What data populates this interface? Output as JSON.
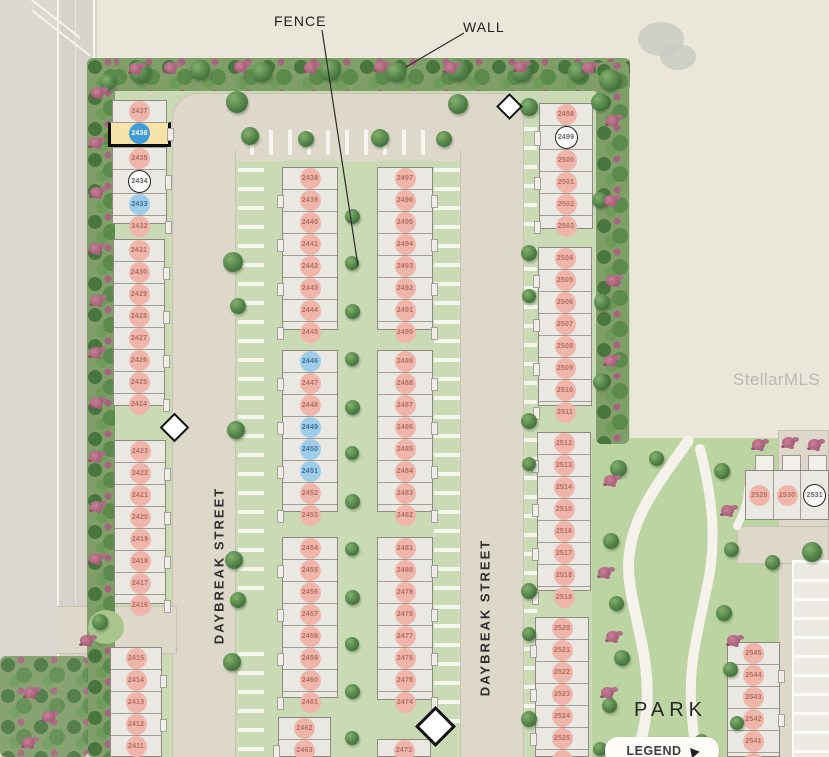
{
  "labels": {
    "fence": "FENCE",
    "wall": "WALL",
    "street": "DAYBREAK STREET",
    "park": "PARK",
    "legend": "LEGEND",
    "watermark": "StellarMLS"
  },
  "colors": {
    "lot_pink": "#efb5ab",
    "lot_blue": "#9fcde9",
    "highlight_unit_yellow": "#f6e3a8",
    "highlight_circle_blue": "#3f9bd8",
    "road_tan": "#ddd8ca",
    "green": "#c9dab4",
    "hedge_green": "#7f9e68"
  },
  "buildings": [
    {
      "name": "bldg-2432-2437",
      "x": 112,
      "y": 100,
      "w": 55,
      "h": 124,
      "dir": "v",
      "porch": "e",
      "lots": [
        {
          "n": "2437",
          "s": "pink"
        },
        {
          "n": "2436",
          "s": "highlight"
        },
        {
          "n": "2435",
          "s": "pink"
        },
        {
          "n": "2434",
          "s": "circled"
        },
        {
          "n": "2433",
          "s": "blue"
        },
        {
          "n": "2432",
          "s": "pink"
        }
      ]
    },
    {
      "name": "bldg-2424-2431",
      "x": 113,
      "y": 239,
      "w": 52,
      "h": 167,
      "dir": "v",
      "porch": "e",
      "lots": [
        {
          "n": "2431",
          "s": "pink"
        },
        {
          "n": "2430",
          "s": "pink"
        },
        {
          "n": "2429",
          "s": "pink"
        },
        {
          "n": "2428",
          "s": "pink"
        },
        {
          "n": "2427",
          "s": "pink"
        },
        {
          "n": "2426",
          "s": "pink"
        },
        {
          "n": "2425",
          "s": "pink"
        },
        {
          "n": "2424",
          "s": "pink"
        }
      ]
    },
    {
      "name": "bldg-2416-2423",
      "x": 114,
      "y": 440,
      "w": 52,
      "h": 164,
      "dir": "v",
      "porch": "e",
      "lots": [
        {
          "n": "2423",
          "s": "pink"
        },
        {
          "n": "2422",
          "s": "pink"
        },
        {
          "n": "2421",
          "s": "pink"
        },
        {
          "n": "2420",
          "s": "pink"
        },
        {
          "n": "2419",
          "s": "pink"
        },
        {
          "n": "2418",
          "s": "pink"
        },
        {
          "n": "2417",
          "s": "pink"
        },
        {
          "n": "2416",
          "s": "pink"
        }
      ]
    },
    {
      "name": "bldg-2410-2415",
      "x": 110,
      "y": 647,
      "w": 52,
      "h": 110,
      "dir": "v",
      "porch": "e",
      "lots": [
        {
          "n": "2415",
          "s": "pink"
        },
        {
          "n": "2414",
          "s": "pink"
        },
        {
          "n": "2413",
          "s": "pink"
        },
        {
          "n": "2412",
          "s": "pink"
        },
        {
          "n": "2411",
          "s": "pink"
        },
        {
          "n": "2410",
          "s": "pink"
        }
      ]
    },
    {
      "name": "bldg-2438-2445",
      "x": 282,
      "y": 167,
      "w": 56,
      "h": 163,
      "dir": "v",
      "porch": "w",
      "lots": [
        {
          "n": "2438",
          "s": "pink"
        },
        {
          "n": "2439",
          "s": "pink"
        },
        {
          "n": "2440",
          "s": "pink"
        },
        {
          "n": "2441",
          "s": "pink"
        },
        {
          "n": "2442",
          "s": "pink"
        },
        {
          "n": "2443",
          "s": "pink"
        },
        {
          "n": "2444",
          "s": "pink"
        },
        {
          "n": "2445",
          "s": "pink"
        }
      ]
    },
    {
      "name": "bldg-2446-2453",
      "x": 282,
      "y": 350,
      "w": 56,
      "h": 162,
      "dir": "v",
      "porch": "w",
      "lots": [
        {
          "n": "2446",
          "s": "blue"
        },
        {
          "n": "2447",
          "s": "pink"
        },
        {
          "n": "2448",
          "s": "pink"
        },
        {
          "n": "2449",
          "s": "blue"
        },
        {
          "n": "2450",
          "s": "blue"
        },
        {
          "n": "2451",
          "s": "blue"
        },
        {
          "n": "2452",
          "s": "pink"
        },
        {
          "n": "2453",
          "s": "pink"
        }
      ]
    },
    {
      "name": "bldg-2454-2461",
      "x": 282,
      "y": 537,
      "w": 56,
      "h": 161,
      "dir": "v",
      "porch": "w",
      "lots": [
        {
          "n": "2454",
          "s": "pink"
        },
        {
          "n": "2455",
          "s": "pink"
        },
        {
          "n": "2456",
          "s": "pink"
        },
        {
          "n": "2457",
          "s": "pink"
        },
        {
          "n": "2458",
          "s": "pink"
        },
        {
          "n": "2459",
          "s": "pink"
        },
        {
          "n": "2460",
          "s": "pink"
        },
        {
          "n": "2461",
          "s": "pink"
        }
      ]
    },
    {
      "name": "bldg-2462-2463",
      "x": 278,
      "y": 717,
      "w": 53,
      "h": 40,
      "dir": "v",
      "porch": "w",
      "lots": [
        {
          "n": "2462",
          "s": "pink"
        },
        {
          "n": "2463",
          "s": "pink"
        }
      ]
    },
    {
      "name": "bldg-2490-2497",
      "x": 377,
      "y": 167,
      "w": 56,
      "h": 163,
      "dir": "v",
      "porch": "e",
      "lots": [
        {
          "n": "2497",
          "s": "pink"
        },
        {
          "n": "2496",
          "s": "pink"
        },
        {
          "n": "2495",
          "s": "pink"
        },
        {
          "n": "2494",
          "s": "pink"
        },
        {
          "n": "2493",
          "s": "pink"
        },
        {
          "n": "2492",
          "s": "pink"
        },
        {
          "n": "2491",
          "s": "pink"
        },
        {
          "n": "2490",
          "s": "pink"
        }
      ]
    },
    {
      "name": "bldg-2482-2489",
      "x": 377,
      "y": 350,
      "w": 56,
      "h": 162,
      "dir": "v",
      "porch": "e",
      "lots": [
        {
          "n": "2489",
          "s": "pink"
        },
        {
          "n": "2488",
          "s": "pink"
        },
        {
          "n": "2487",
          "s": "pink"
        },
        {
          "n": "2486",
          "s": "pink"
        },
        {
          "n": "2485",
          "s": "pink"
        },
        {
          "n": "2484",
          "s": "pink"
        },
        {
          "n": "2483",
          "s": "pink"
        },
        {
          "n": "2482",
          "s": "pink"
        }
      ]
    },
    {
      "name": "bldg-2474-2481",
      "x": 377,
      "y": 537,
      "w": 56,
      "h": 163,
      "dir": "v",
      "porch": "e",
      "lots": [
        {
          "n": "2481",
          "s": "pink"
        },
        {
          "n": "2480",
          "s": "pink"
        },
        {
          "n": "2479",
          "s": "pink"
        },
        {
          "n": "2478",
          "s": "pink"
        },
        {
          "n": "2477",
          "s": "pink"
        },
        {
          "n": "2476",
          "s": "pink"
        },
        {
          "n": "2475",
          "s": "pink"
        },
        {
          "n": "2474",
          "s": "pink"
        }
      ]
    },
    {
      "name": "bldg-2473",
      "x": 377,
      "y": 739,
      "w": 54,
      "h": 18,
      "dir": "v",
      "porch": "e",
      "lots": [
        {
          "n": "2473",
          "s": "pink"
        }
      ]
    },
    {
      "name": "bldg-2498-2503",
      "x": 539,
      "y": 103,
      "w": 54,
      "h": 126,
      "dir": "v",
      "porch": "w",
      "lots": [
        {
          "n": "2498",
          "s": "pink"
        },
        {
          "n": "2499",
          "s": "circled"
        },
        {
          "n": "2500",
          "s": "pink"
        },
        {
          "n": "2501",
          "s": "pink"
        },
        {
          "n": "2502",
          "s": "pink"
        },
        {
          "n": "2503",
          "s": "pink"
        }
      ]
    },
    {
      "name": "bldg-2504-2511",
      "x": 538,
      "y": 247,
      "w": 54,
      "h": 159,
      "dir": "v",
      "porch": "w",
      "lots": [
        {
          "n": "2504",
          "s": "pink"
        },
        {
          "n": "2505",
          "s": "pink"
        },
        {
          "n": "2506",
          "s": "pink"
        },
        {
          "n": "2507",
          "s": "pink"
        },
        {
          "n": "2508",
          "s": "pink"
        },
        {
          "n": "2509",
          "s": "pink"
        },
        {
          "n": "2510",
          "s": "pink"
        },
        {
          "n": "2511",
          "s": "pink"
        }
      ]
    },
    {
      "name": "bldg-2512-2519",
      "x": 537,
      "y": 432,
      "w": 54,
      "h": 159,
      "dir": "v",
      "porch": "w",
      "lots": [
        {
          "n": "2512",
          "s": "pink"
        },
        {
          "n": "2513",
          "s": "pink"
        },
        {
          "n": "2514",
          "s": "pink"
        },
        {
          "n": "2515",
          "s": "pink"
        },
        {
          "n": "2516",
          "s": "pink"
        },
        {
          "n": "2517",
          "s": "pink"
        },
        {
          "n": "2518",
          "s": "pink"
        },
        {
          "n": "2519",
          "s": "pink"
        }
      ]
    },
    {
      "name": "bldg-2520-2526",
      "x": 535,
      "y": 617,
      "w": 54,
      "h": 140,
      "dir": "v",
      "porch": "w",
      "lots": [
        {
          "n": "2520",
          "s": "pink"
        },
        {
          "n": "2521",
          "s": "pink"
        },
        {
          "n": "2522",
          "s": "pink"
        },
        {
          "n": "2523",
          "s": "pink"
        },
        {
          "n": "2524",
          "s": "pink"
        },
        {
          "n": "2525",
          "s": "pink"
        },
        {
          "n": "2526",
          "s": "pink"
        }
      ]
    },
    {
      "name": "bldg-2529-2531",
      "x": 745,
      "y": 470,
      "w": 84,
      "h": 50,
      "dir": "h",
      "porch": "n",
      "lots": [
        {
          "n": "2529",
          "s": "pink"
        },
        {
          "n": "2530",
          "s": "pink"
        },
        {
          "n": "2531",
          "s": "circled"
        }
      ]
    },
    {
      "name": "bldg-2540-2545",
      "x": 727,
      "y": 642,
      "w": 53,
      "h": 115,
      "dir": "v",
      "porch": "e",
      "lots": [
        {
          "n": "2545",
          "s": "pink"
        },
        {
          "n": "2544",
          "s": "pink"
        },
        {
          "n": "2543",
          "s": "pink"
        },
        {
          "n": "2542",
          "s": "pink"
        },
        {
          "n": "2541",
          "s": "pink"
        },
        {
          "n": "2540",
          "s": "pink"
        }
      ]
    }
  ]
}
